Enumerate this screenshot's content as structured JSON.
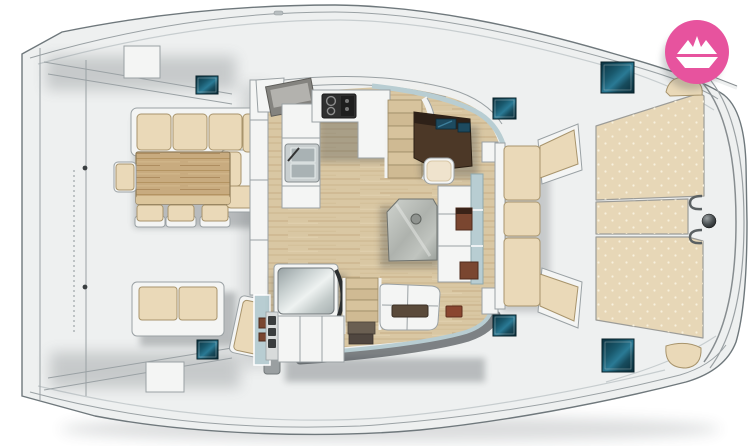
{
  "diagram": {
    "type": "boat-floor-plan",
    "view": "top-down deck layout",
    "areas": [
      "aft-cockpit-dining",
      "galley",
      "navigation-station",
      "salon-table",
      "berth",
      "port-stairs",
      "starboard-stairs",
      "forward-cockpit-bench",
      "sunpads",
      "deck-hatches",
      "anchor-fitting"
    ],
    "deck_hatches_count": 6,
    "dining_stools_count": 3
  },
  "logo": {
    "icon": "paper-boat-icon",
    "shape": "circle"
  },
  "colors": {
    "page-bg": "#ffffff",
    "deck": "#eef0f0",
    "deck-line": "#9aa1a4",
    "structure-line": "#6f787c",
    "counter": "#f4f5f4",
    "cushion": "#ead9b8",
    "cushion-light": "#f6eedb",
    "cushion-edge": "#a8946c",
    "sunpad": "#e7d7b7",
    "wood-floor": "#d9c7a3",
    "wood-table": "#c8ab7f",
    "hatch-dark": "#0b3240",
    "hatch-light": "#2a7a95",
    "nav-brown": "#4c3827",
    "nav-brown-dark": "#2e2118",
    "screen-blue": "#1d4a5f",
    "glass": "#b8cdd2",
    "rim-dark": "#7d8184",
    "table-gray": "#aeb2ad",
    "accent-wood-dark": "#7a4630",
    "logo-pink": "#e7539e",
    "shadow": "#3c444a"
  }
}
